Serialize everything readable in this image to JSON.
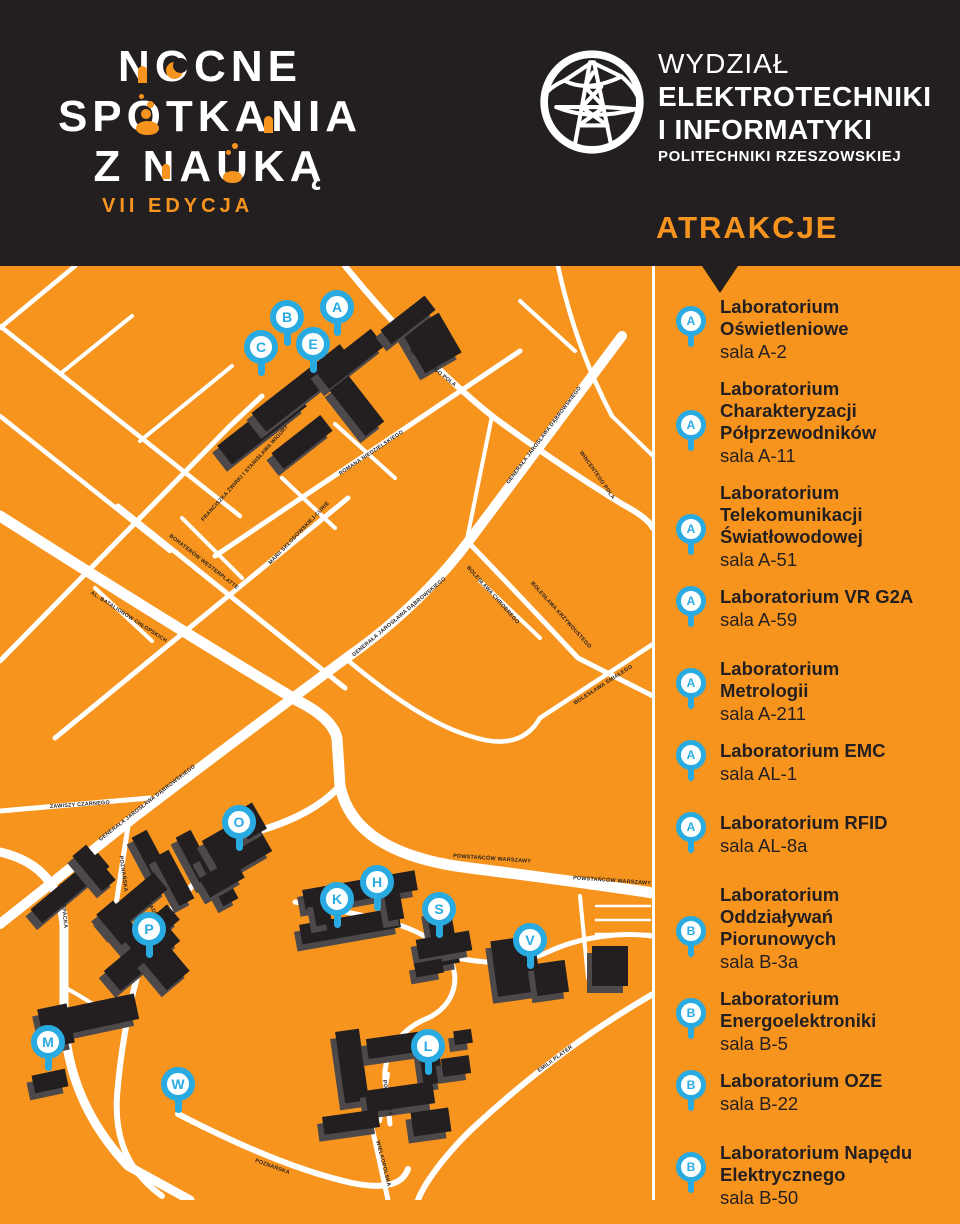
{
  "header": {
    "event_logo": {
      "line1": "NOCNE",
      "line2": "SPOTKANIA",
      "line3": "Z NAUKĄ",
      "edition": "VII EDYCJA",
      "decoration_icons": [
        "door-icon",
        "crescent-moon-icon",
        "flask-icon",
        "bubbles-icon"
      ]
    },
    "faculty": {
      "line1": "WYDZIAŁ",
      "line2": "ELEKTROTECHNIKI",
      "line3": "I INFORMATYKI",
      "line4": "POLITECHNIKI RZESZOWSKIEJ",
      "logo_icon": "power-pylon-icon"
    },
    "sidebar_title": "ATRAKCJE"
  },
  "colors": {
    "orange": "#F7941E",
    "black": "#231F20",
    "pin_blue": "#29ABE2",
    "white": "#FFFFFF",
    "building_shadow": "#4D494A"
  },
  "map": {
    "pins": [
      {
        "letter": "A",
        "x": 337,
        "y": 41
      },
      {
        "letter": "B",
        "x": 287,
        "y": 51
      },
      {
        "letter": "C",
        "x": 261,
        "y": 81
      },
      {
        "letter": "E",
        "x": 313,
        "y": 78
      },
      {
        "letter": "O",
        "x": 239,
        "y": 556
      },
      {
        "letter": "H",
        "x": 377,
        "y": 616
      },
      {
        "letter": "K",
        "x": 337,
        "y": 633
      },
      {
        "letter": "S",
        "x": 439,
        "y": 643
      },
      {
        "letter": "P",
        "x": 149,
        "y": 663
      },
      {
        "letter": "V",
        "x": 530,
        "y": 674
      },
      {
        "letter": "M",
        "x": 48,
        "y": 776
      },
      {
        "letter": "L",
        "x": 428,
        "y": 780
      },
      {
        "letter": "W",
        "x": 178,
        "y": 818
      }
    ],
    "street_labels": [
      "WINCENTEGO POLA",
      "WINCENTEGO POLA",
      "ROMANA NIEDZIELSKIEGO",
      "GENERAŁA JAROSŁAWA DĄBROWSKIEGO",
      "GENERAŁA JAROSŁAWA DĄBROWSKIEGO",
      "GENERAŁA JAROSŁAWA DĄBROWSKIEGO",
      "MARII SKŁODOWSKIEJ-CURIE",
      "FRANCISZKA ŻWIRKI I STANISŁAWA WIGURY",
      "BOHATERÓW WESTERPLATTE",
      "AL. BATALIONÓW CHŁOPSKICH",
      "ZAWISZY CZARNEGO",
      "PODKARPACKA",
      "POZNAŃSKA",
      "AKADEMICKA",
      "POWSTAŃCÓW WARSZAWY",
      "POWSTAŃCÓW WARSZAWY",
      "EMILII PLATER",
      "POZNAŃSKA",
      "POZNAŃSKA",
      "WIELKOPOLSKA",
      "BOLESŁAWA KRZYWOUSTEGO",
      "BOLESŁAWA ŚMIAŁEGO",
      "BOLESŁAWA CHROBREGO"
    ]
  },
  "attractions": [
    {
      "marker": "A",
      "title": "Laboratorium Oświetleniowe",
      "room": "sala A-2"
    },
    {
      "marker": "A",
      "title": "Laboratorium Charakteryzacji Półprzewodników",
      "room": "sala A-11"
    },
    {
      "marker": "A",
      "title": "Laboratorium Telekomunikacji Światłowodowej",
      "room": "sala A-51"
    },
    {
      "marker": "A",
      "title": "Laboratorium VR G2A",
      "room": "sala A-59"
    },
    {
      "marker": "A",
      "title": "Laboratorium Metrologii",
      "room": "sala A-211"
    },
    {
      "marker": "A",
      "title": "Laboratorium EMC",
      "room": "sala AL-1"
    },
    {
      "marker": "A",
      "title": "Laboratorium RFID",
      "room": "sala AL-8a"
    },
    {
      "marker": "B",
      "title": "Laboratorium Oddziaływań Piorunowych",
      "room": "sala B-3a"
    },
    {
      "marker": "B",
      "title": "Laboratorium Energoelektroniki",
      "room": "sala B-5"
    },
    {
      "marker": "B",
      "title": "Laboratorium OZE",
      "room": "sala B-22"
    },
    {
      "marker": "B",
      "title": "Laboratorium Napędu Elektrycznego",
      "room": "sala B-50"
    }
  ]
}
